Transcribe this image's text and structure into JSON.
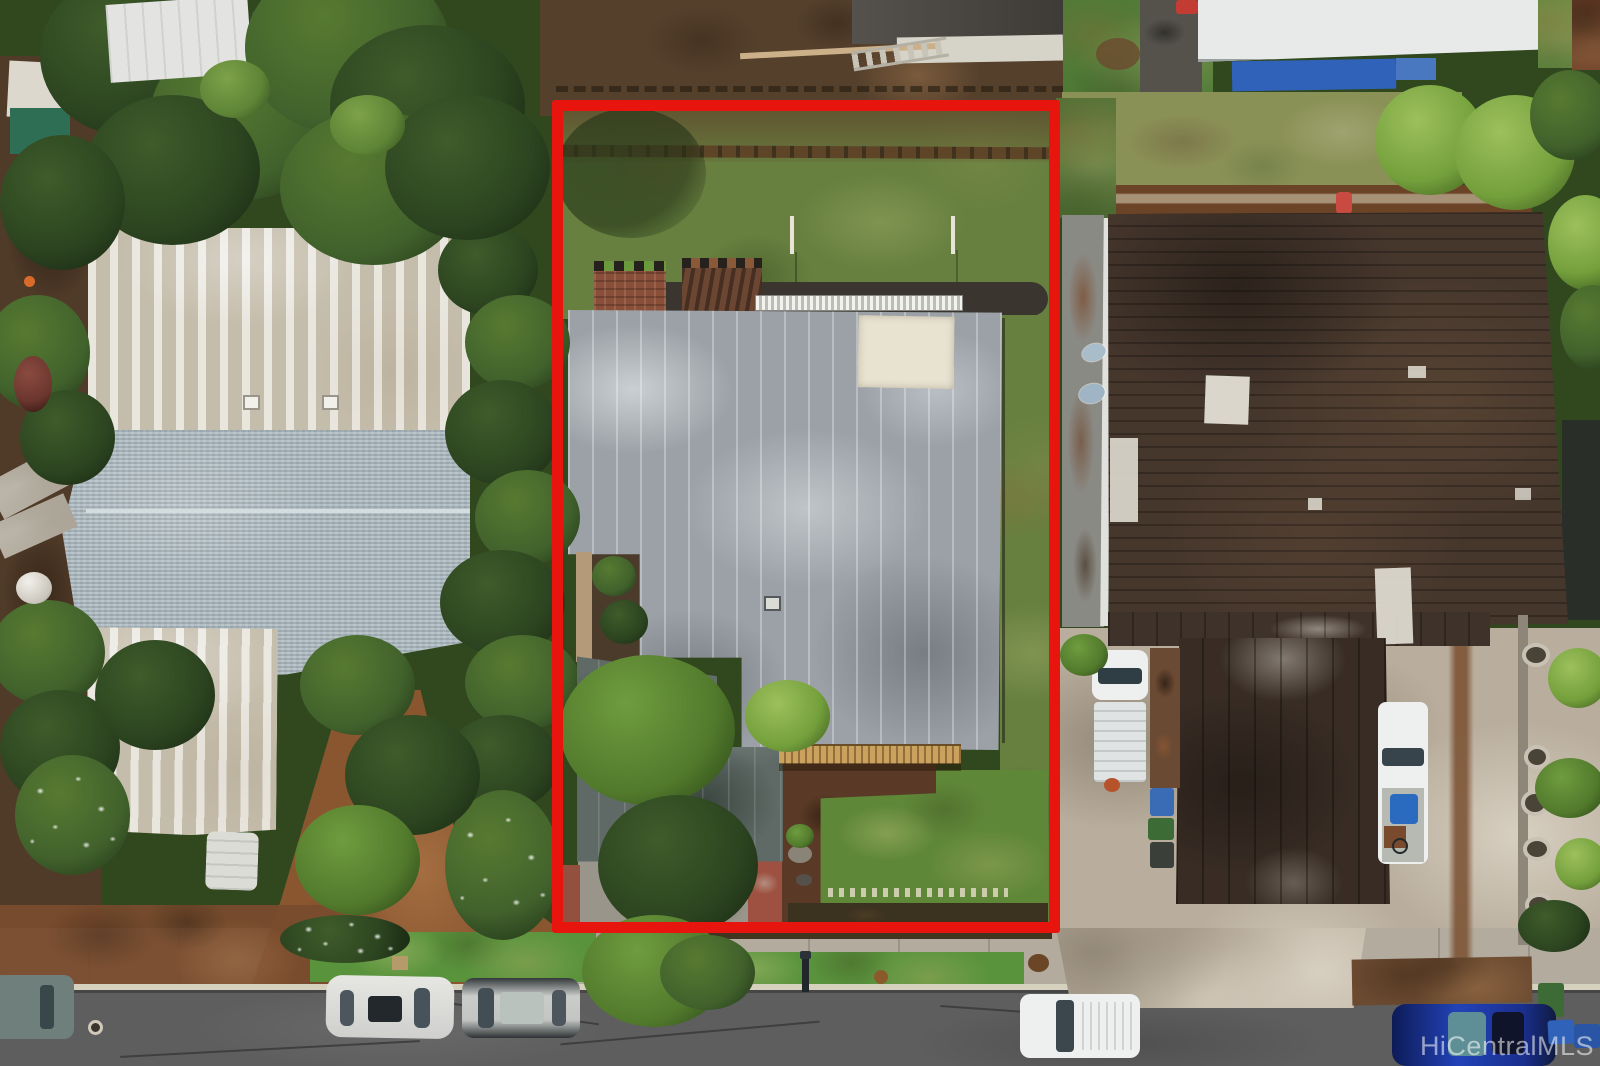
{
  "watermark": {
    "text": "HiCentralMLS"
  },
  "palette": {
    "boundary_red": "#e8150f",
    "road_asphalt": "#5e5e5e",
    "sidewalk_concrete": "#b3ac9e",
    "driveway_concrete": "#b9ae9d",
    "grass_yard": "#67803f",
    "grass_front": "#5f8738",
    "grass_dry": "#8a9156",
    "dirt_rust": "#7a4c2e",
    "dirt_dark": "#4e3a27",
    "roof_main_gray": "#9ba1a6",
    "roof_secondary": "#5f6a66",
    "roof_left_white": "#cec7b6",
    "roof_left_shingle": "#aebcc3",
    "roof_right_brown": "#46372d",
    "roof_garage_brown": "#382c24",
    "deck_wood": "#c09a5a",
    "brick_red": "#9e5140",
    "awning_white": "#e9e9e4",
    "patch_cream": "#e8e2d1",
    "vehicle_white": "#eef0ef",
    "vehicle_blue": "#20399f",
    "tarp_blue": "#2f62b8"
  }
}
